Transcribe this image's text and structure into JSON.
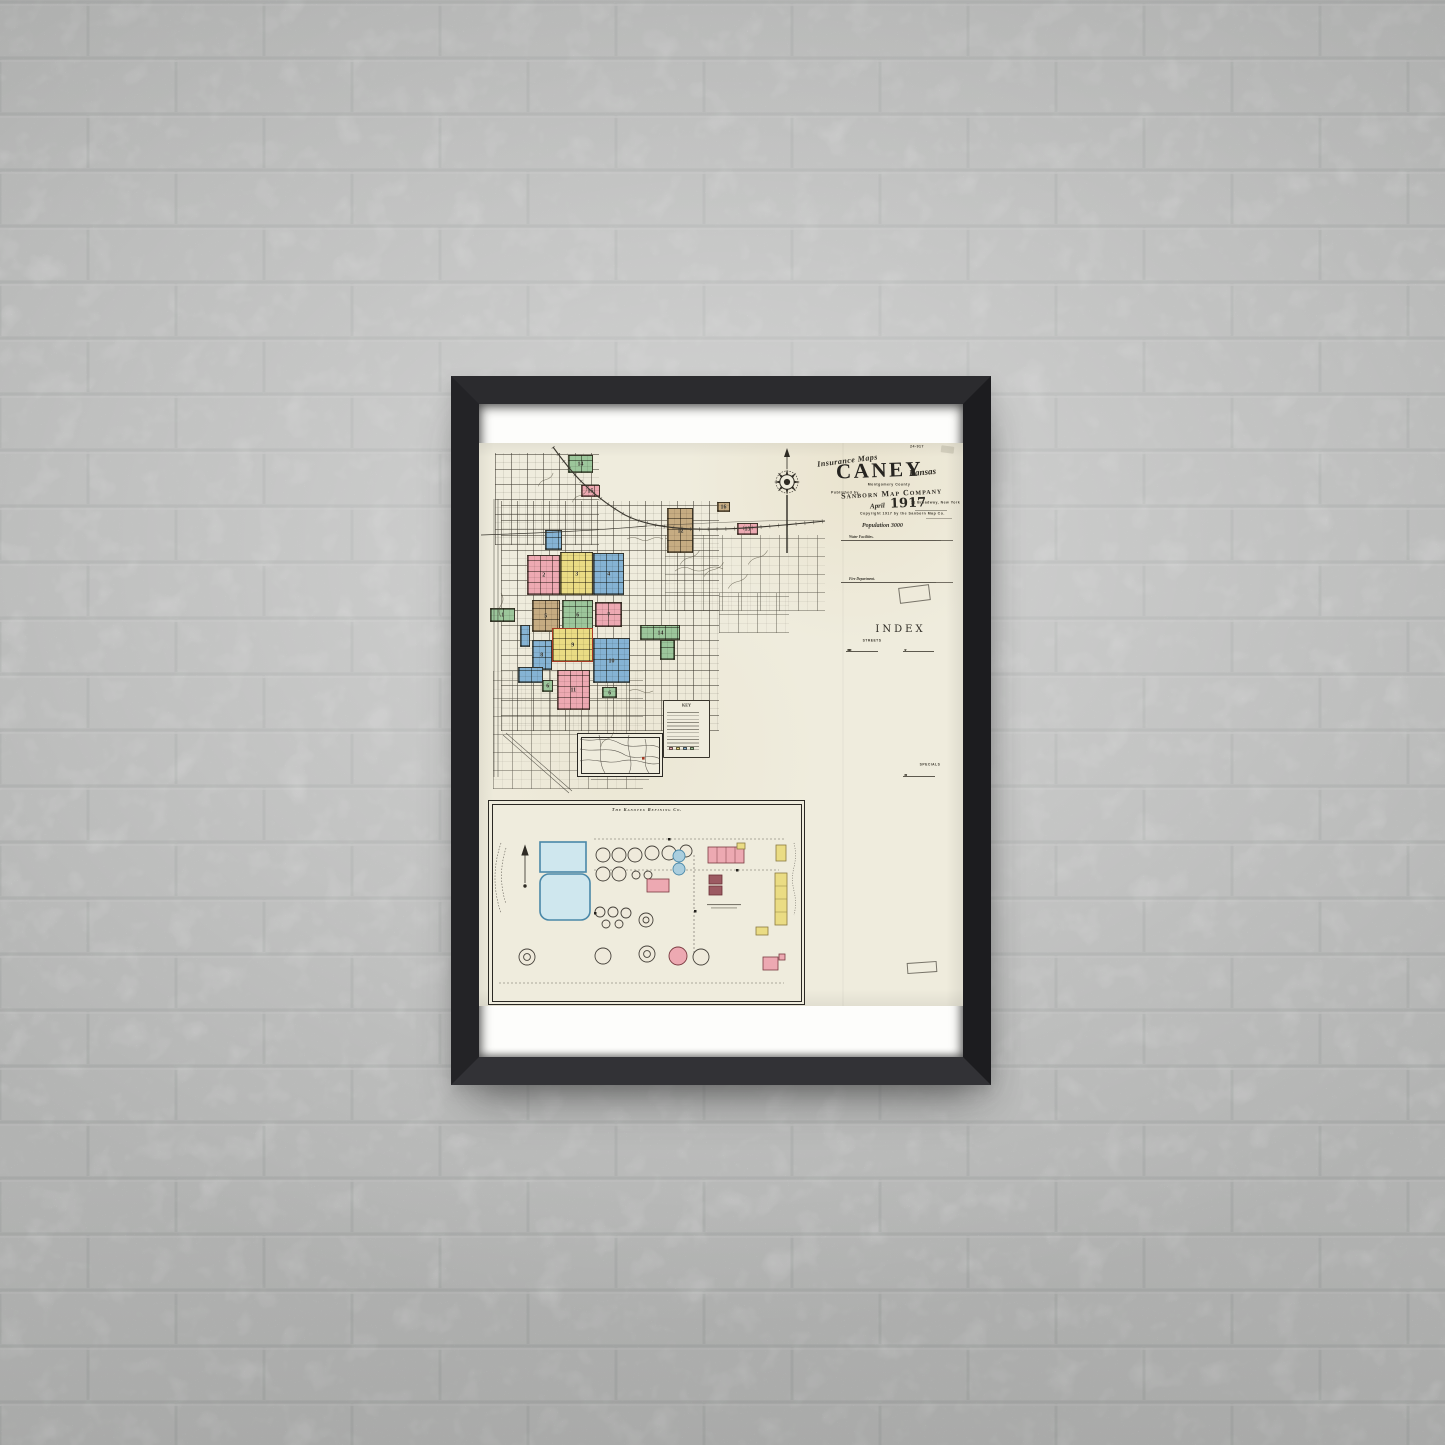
{
  "scene": {
    "type": "framed-map-poster-on-white-brick-wall",
    "wall_color": "#f0f1f0",
    "frame_color": "#232325",
    "poster_color": "#fdfdfb",
    "sheet_color": "#efecdd"
  },
  "header": {
    "plate_no": "24-917",
    "series": "Insurance Maps",
    "title": "CANEY",
    "state": "Kansas",
    "county": "Montgomery County",
    "published_by": "Published by",
    "publisher": "Sanborn Map Company",
    "date_script": "April",
    "date_year": "1917",
    "address": "11 Broadway, New York",
    "copyright": "Copyright 1917 by the Sanborn Map Co.",
    "population": "Population 3000",
    "water_heading": "Water Facilities.",
    "fire_heading": "Fire Department.",
    "water_lines": 9,
    "fire_lines": 6
  },
  "index": {
    "title": "INDEX",
    "streets_heading": "STREETS",
    "specials_heading": "SPECIALS",
    "left_count": 58,
    "right_top_count": 20,
    "right_bottom_count": 38,
    "street_letters_left": [
      "B",
      "C",
      "D",
      "E",
      "F",
      "H",
      "M"
    ],
    "street_letters_right": [
      "S",
      "T",
      "V",
      "W"
    ],
    "special_letters": [
      "A",
      "B",
      "C",
      "E",
      "F",
      "K",
      "M",
      "S",
      "W"
    ]
  },
  "map": {
    "key_title": "KEY",
    "compass": "north-compass-rose",
    "blocks": [
      {
        "n": "14",
        "color": "green"
      },
      {
        "n": "15",
        "color": "pink"
      },
      {
        "n": "16",
        "color": "tan"
      },
      {
        "n": "12",
        "color": "tan"
      },
      {
        "n": "13",
        "color": "pink"
      },
      {
        "n": "",
        "color": "blue"
      },
      {
        "n": "2",
        "color": "pink"
      },
      {
        "n": "3",
        "color": "yellow"
      },
      {
        "n": "4",
        "color": "blue"
      },
      {
        "n": "5",
        "color": "tan"
      },
      {
        "n": "6",
        "color": "green"
      },
      {
        "n": "7",
        "color": "pink"
      },
      {
        "n": "1",
        "color": "green"
      },
      {
        "n": "",
        "color": "blue"
      },
      {
        "n": "9",
        "color": "yellow"
      },
      {
        "n": "8",
        "color": "blue"
      },
      {
        "n": "10",
        "color": "blue"
      },
      {
        "n": "14",
        "color": "green"
      },
      {
        "n": "",
        "color": "green"
      },
      {
        "n": "11",
        "color": "pink"
      },
      {
        "n": "6",
        "color": "green"
      },
      {
        "n": "6",
        "color": "green"
      },
      {
        "n": "",
        "color": "blue"
      }
    ],
    "inset": {
      "title": "The Kanotex Refining Co.",
      "pond1": "Pond",
      "pond2": "Pond"
    }
  },
  "palette": {
    "pink": "#eda9b2",
    "yellow": "#eadc84",
    "blue": "#85b3d4",
    "green": "#9cc69b",
    "tan": "#c6ac82",
    "red_outline": "#a93a22",
    "pond_fill": "#cfe7ee",
    "pond_stroke": "#4a88a8",
    "ink": "#35332c"
  }
}
